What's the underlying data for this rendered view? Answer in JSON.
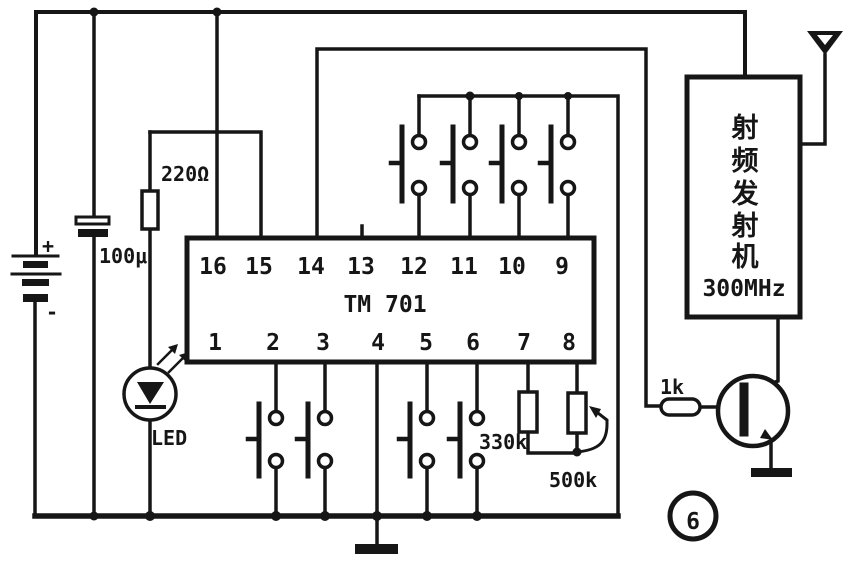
{
  "figure_number": "6",
  "battery": {
    "plus_label": "+",
    "minus_label": "-"
  },
  "capacitor": {
    "label": "100μ"
  },
  "led": {
    "label": "LED"
  },
  "resistors": {
    "r220": "220Ω",
    "r330k": "330k",
    "r500k": "500k",
    "r1k": "1k"
  },
  "ic": {
    "name": "TM 701",
    "top_pins": [
      "16",
      "15",
      "14",
      "13",
      "12",
      "11",
      "10",
      "9"
    ],
    "bottom_pins": [
      "1",
      "2",
      "3",
      "4",
      "5",
      "6",
      "7",
      "8"
    ]
  },
  "rf_transmitter": {
    "name": "射频发射机",
    "name_chars": [
      "射",
      "频",
      "发",
      "射",
      "机"
    ],
    "frequency": "300MHz"
  },
  "colors": {
    "ink": "#161616",
    "paper": "#ffffff"
  }
}
